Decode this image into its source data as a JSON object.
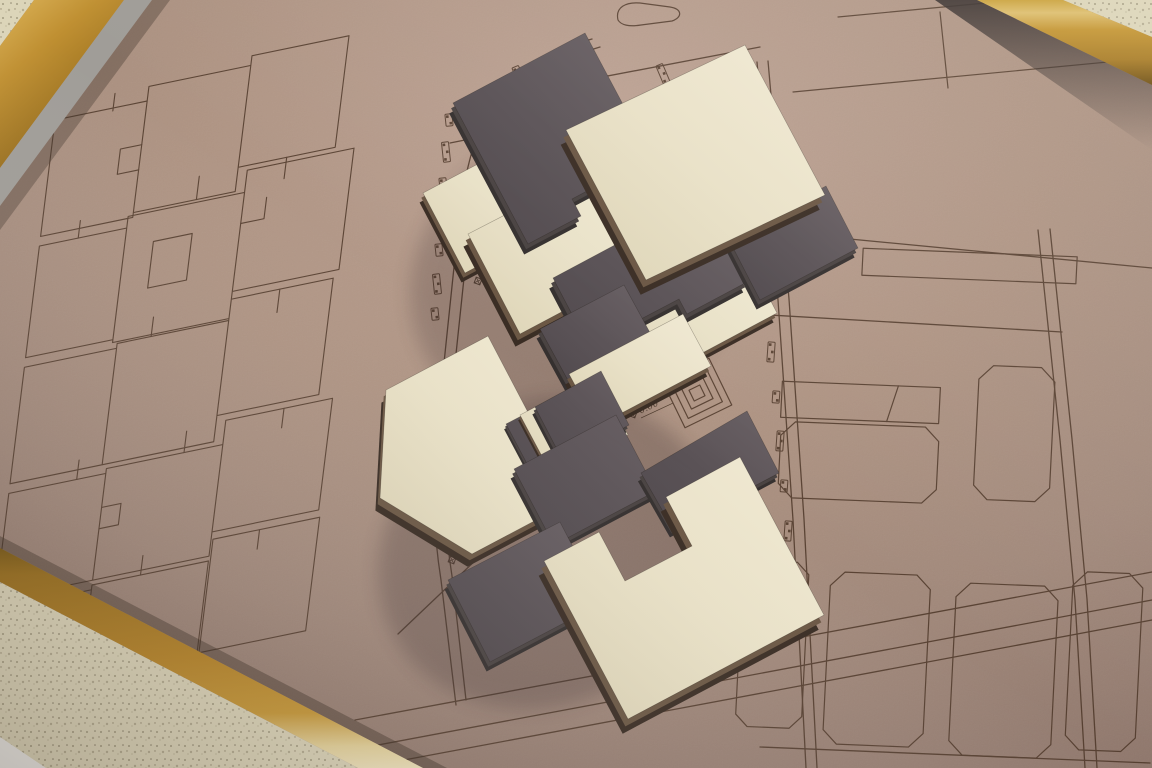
{
  "photo": {
    "annotations": {
      "level_0": "0.00",
      "level_p084": "+0.84",
      "level_m104": "-1.04",
      "level_m084": "-0.84"
    },
    "colors": {
      "floor": "#dcd5b9",
      "frame_gold": "#b8862a",
      "frame_gold_light": "#e6d49c",
      "frame_gold_dark": "#7a5a16",
      "board": "#ab9080",
      "board_light": "#bda293",
      "board_dark": "#8e766b",
      "etch_line": "#4a3425",
      "slab_cream": "#e8e0c8",
      "slab_cream_bright": "#f1ead4",
      "slab_dark": "#5a5256",
      "slab_dark_deep": "#4e474b",
      "slab_edge": "#3a2d24",
      "slab_edge_mid": "#6b5744",
      "dark_edge": "#35302f",
      "dark_edge_mid": "#4a4342",
      "shadow": "#2e2226",
      "metal_strip": "#a09d98",
      "tile_white": "#ecebe6"
    }
  }
}
